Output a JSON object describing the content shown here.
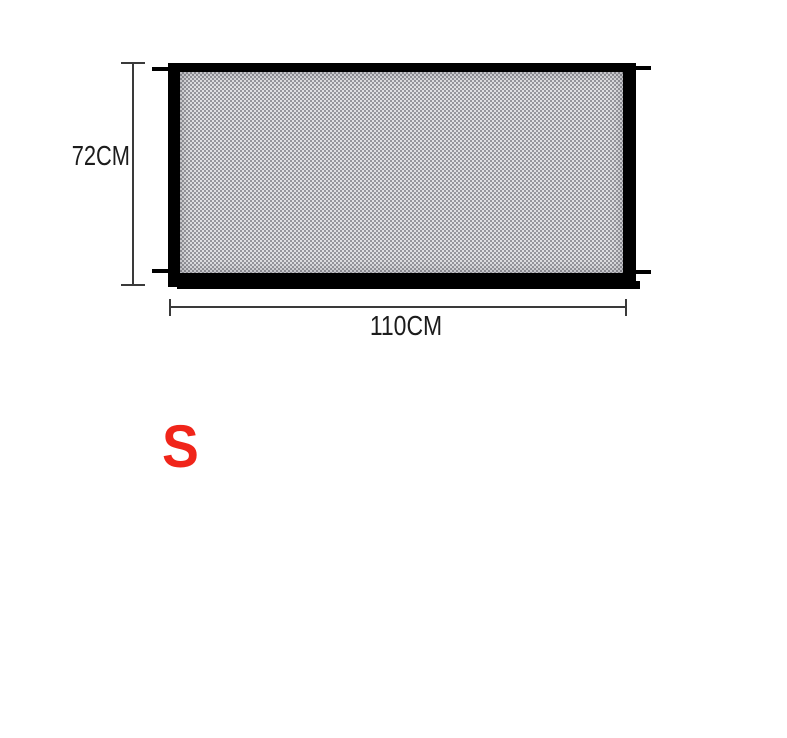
{
  "colors": {
    "background": "#ffffff",
    "frame": "#000000",
    "mesh_light": "#e0e0e3",
    "mesh_dark": "#96969c",
    "dimension_line": "#3a3a3a",
    "label_text": "#1c1c1c",
    "size_accent": "#f0251a"
  },
  "diagram": {
    "subject": "black mesh safety-gate panel with mounting pegs",
    "height_label": "72CM",
    "width_label": "110CM",
    "size_label": "S"
  }
}
